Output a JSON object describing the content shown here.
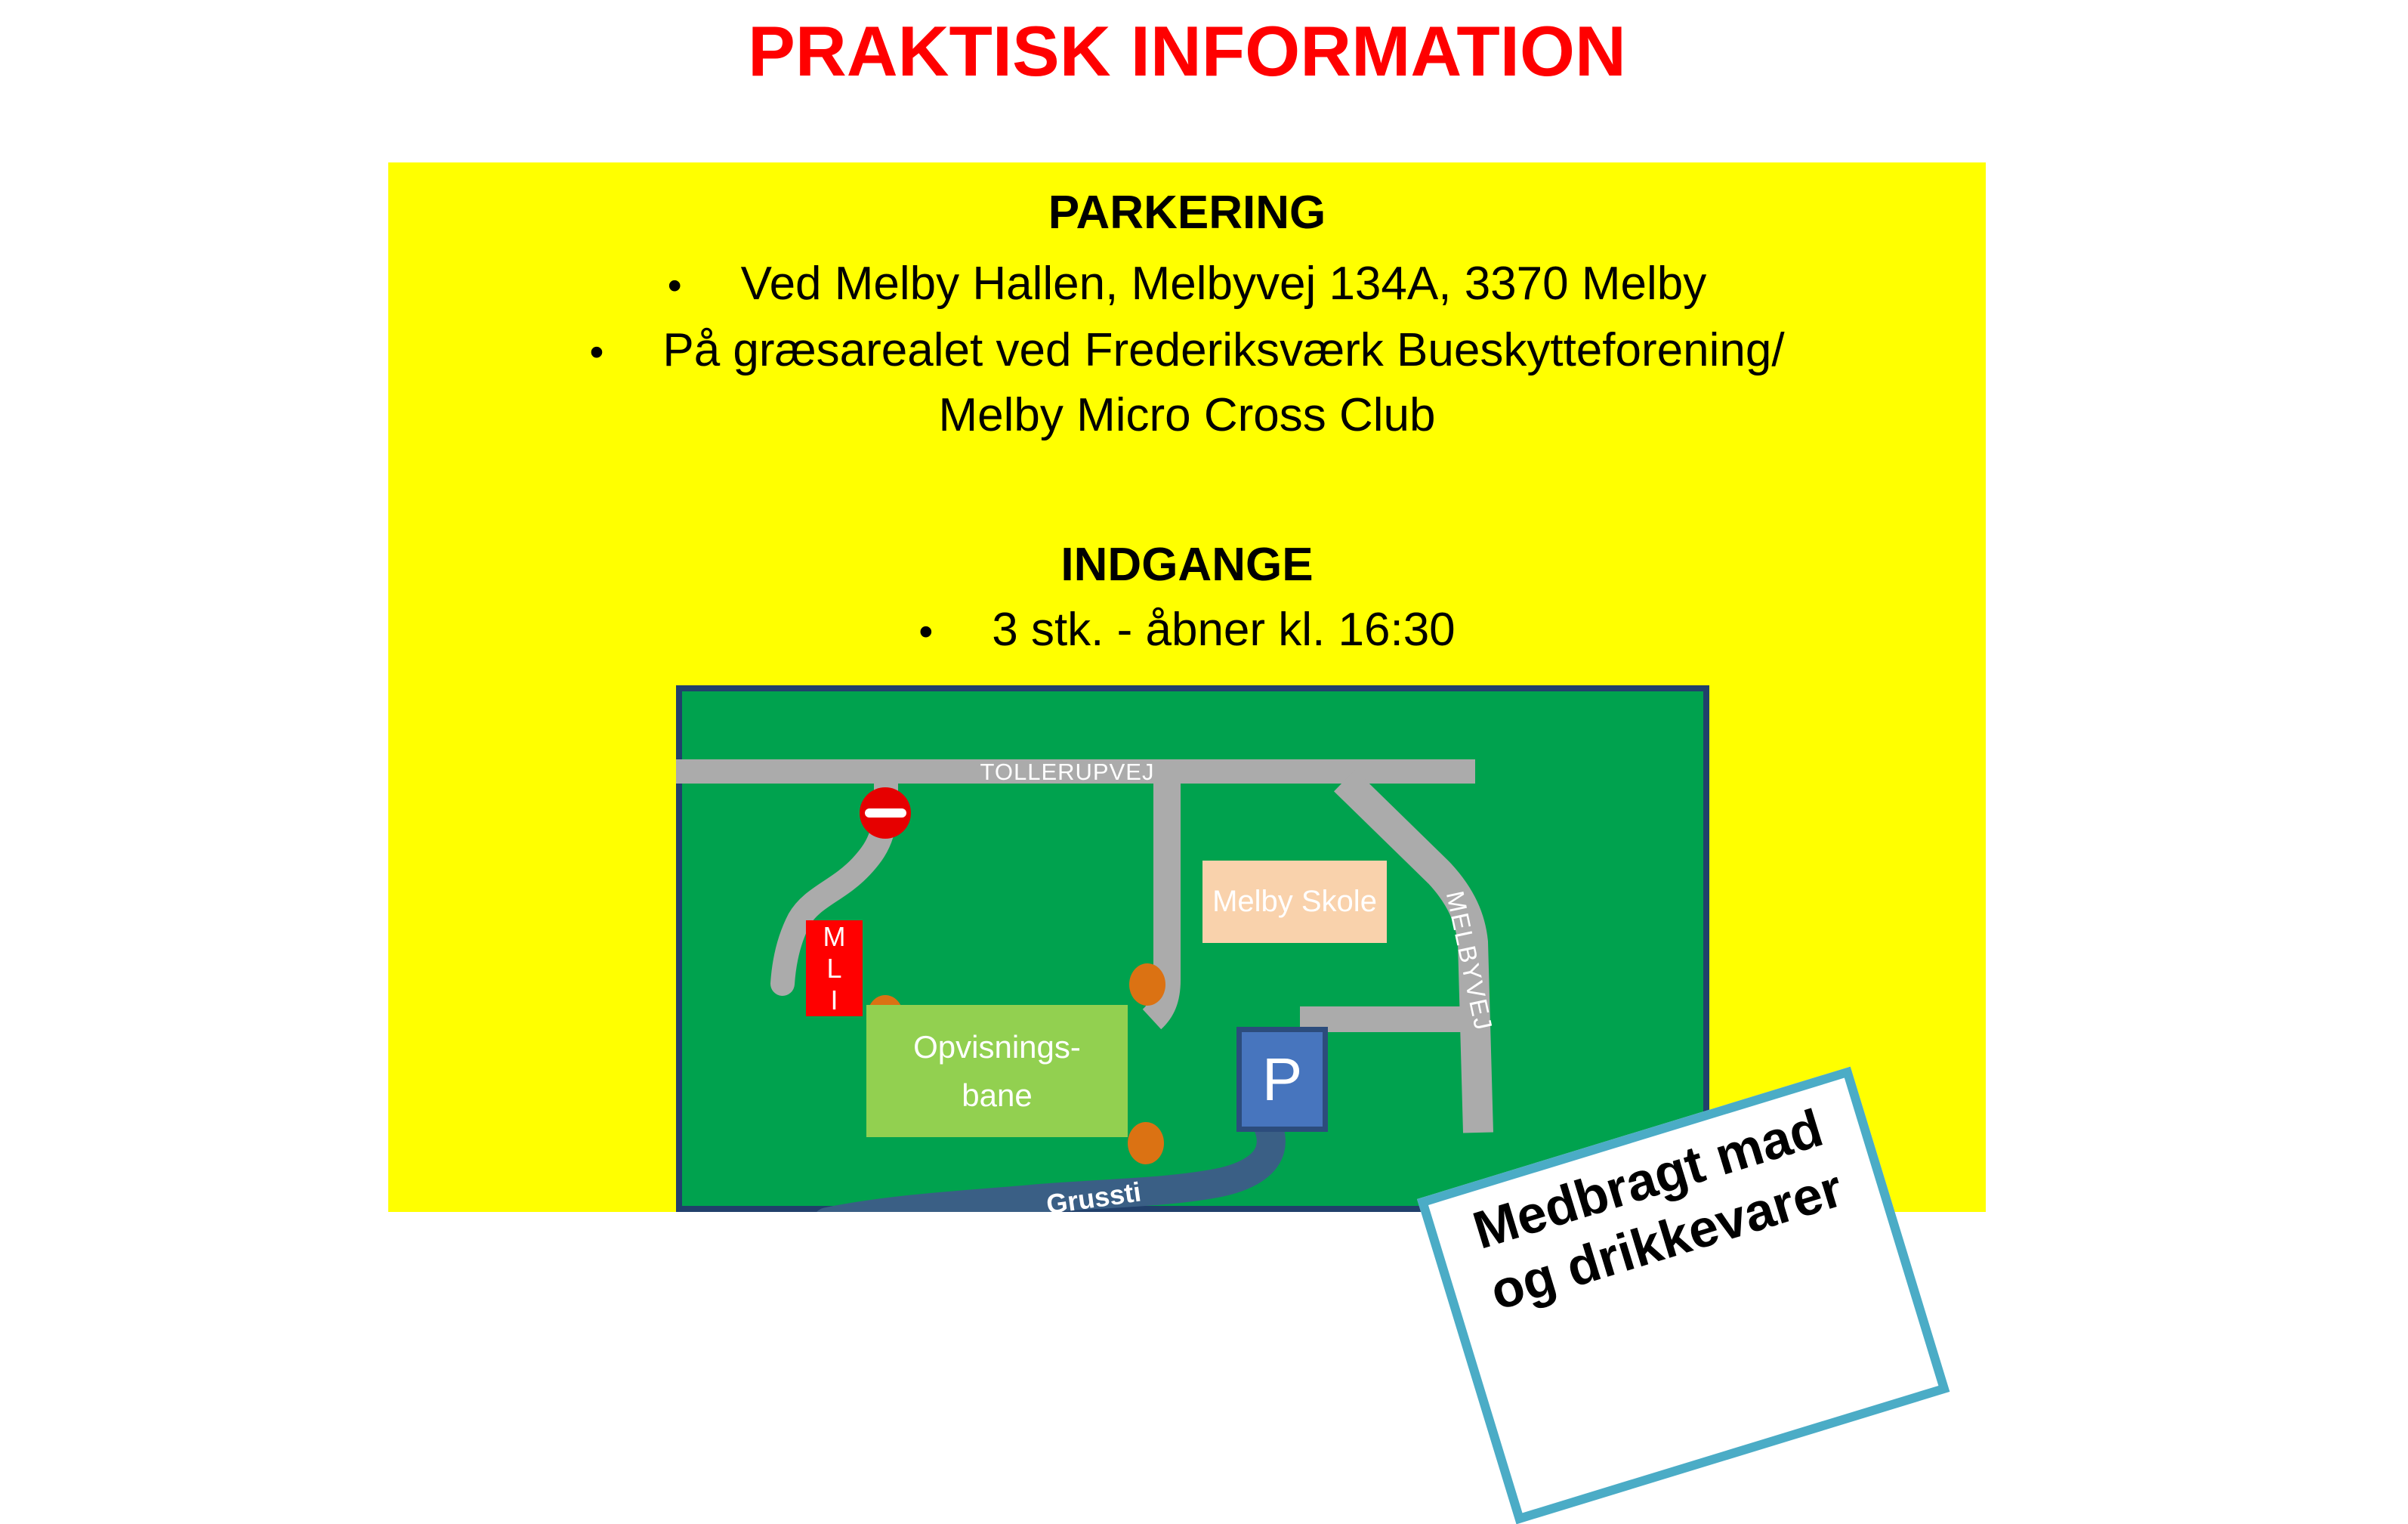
{
  "title": {
    "text": "PRAKTISK INFORMATION",
    "color": "#FF0000"
  },
  "info_panel": {
    "background": "#FFFF00",
    "bullet_char": "•",
    "parkering": {
      "heading": "PARKERING",
      "bullet1": "Ved Melby Hallen, Melbyvej 134A, 3370 Melby",
      "bullet2_line1": "På græsarealet ved Frederiksværk Bueskytteforening/",
      "bullet2_line2": "Melby Micro Cross Club"
    },
    "indgange": {
      "heading": "INDGANGE",
      "bullet1": "3 stk. - åbner kl. 16:30"
    }
  },
  "map": {
    "background": "#00A24E",
    "border_color": "#21406B",
    "road_color": "#ABABAB",
    "roads": {
      "tollerupvej": "TOLLERUPVEJ",
      "melbyvej": "MELBYVEJ"
    },
    "buildings": {
      "school": "Melby Skole",
      "mli_m": "M",
      "mli_l": "L",
      "mli_i": "I",
      "arena_line1": "Opvisnings-",
      "arena_line2": "bane",
      "parking": "P"
    },
    "path_label": "Grussti",
    "colors": {
      "school_fill": "#F9D2AC",
      "mli_fill": "#FF0000",
      "arena_fill": "#92D050",
      "parking_fill": "#4775BE",
      "parking_border": "#2C4C7C",
      "no_entry_red": "#E60000",
      "entrance_dot": "#DB7213",
      "gravel_path": "#3A5F85"
    }
  },
  "sign": {
    "line1": "Medbragt mad",
    "line2": "og drikkevarer",
    "border_color": "#4BACC6"
  }
}
